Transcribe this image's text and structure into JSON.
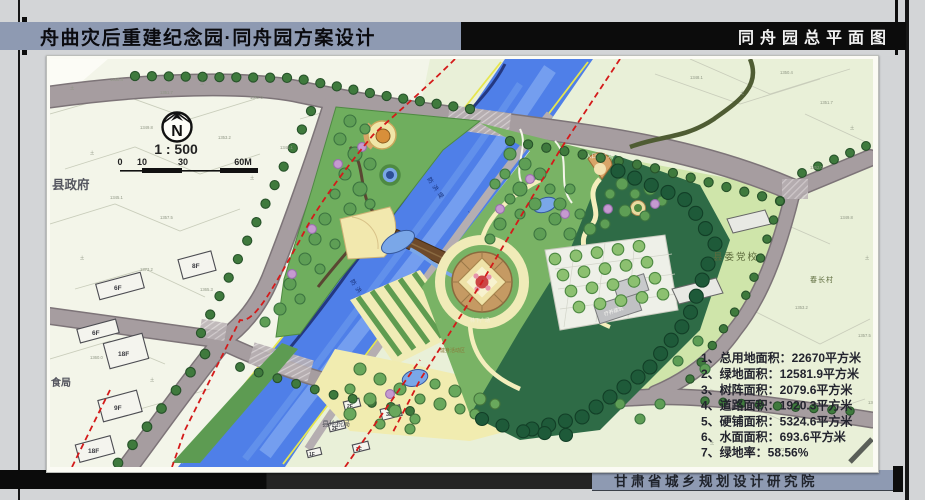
{
  "header": {
    "title_left": "舟曲灾后重建纪念园·同舟园方案设计",
    "title_right": "同舟园总平面图"
  },
  "footer": {
    "institute": "甘肃省城乡规划设计研究院"
  },
  "compass": {
    "letter": "N",
    "scale_text": "1 : 500",
    "ticks": [
      "0",
      "10",
      "30",
      "60M"
    ]
  },
  "stats": {
    "items": [
      "1、总用地面积：22670平方米",
      "2、绿地面积：12581.9平方米",
      "3、树阵面积：2079.6平方米",
      "4、道路面积：1920.3平方米",
      "5、硬铺面积：5324.6平方米",
      "6、水面面积：693.6平方米",
      "7、绿地率：58.56%"
    ]
  },
  "map_labels": {
    "county_gov": "县政府",
    "grain_bureau": "食局",
    "tax_bureau": "县地税局",
    "east_street": "东街",
    "party_school": "县委党校",
    "village": "春长村",
    "entry_plaza": "入口小广场",
    "sanatorium": "疗养建筑",
    "grove_plaza": "林下广场",
    "fitness_area": "健身活动区",
    "dike_west": "防洪堤",
    "dike_east": "防洪堤",
    "river_name": "三眼峪"
  },
  "building_labels": [
    "8F",
    "6F",
    "6F",
    "18F",
    "9F",
    "18F",
    "3F",
    "2F",
    "2F",
    "2F",
    "1F"
  ],
  "cadastral_marks": [
    "土",
    "1350.4",
    "1351.7",
    "土",
    "1352.0",
    "1349.8",
    "土",
    "1353.2",
    "1345.1",
    "1357.5",
    "土",
    "1373.2",
    "1365.3",
    "1360.0",
    "土",
    "1348.1"
  ],
  "colors": {
    "title_bar": "#8e9ab2",
    "river_blue": "#4f7fe8",
    "road_gray": "#a69da0",
    "axis_red": "#d41a1a"
  }
}
